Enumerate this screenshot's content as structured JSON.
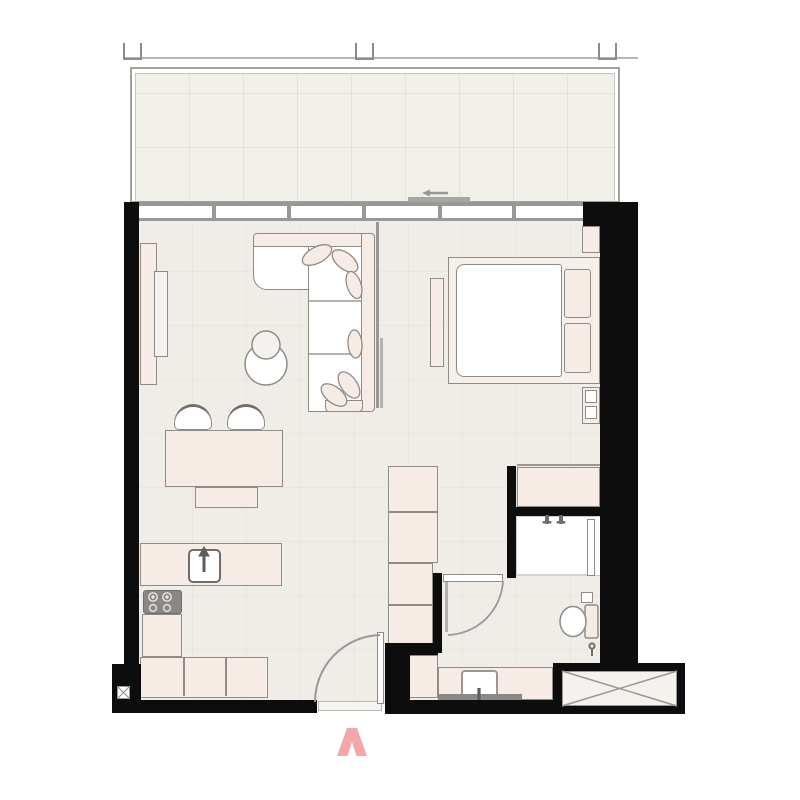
{
  "meta": {
    "title": "One-bedroom apartment floor plan with balcony",
    "type": "architectural-floor-plan"
  },
  "colors": {
    "wall": "#0d0d0d",
    "floor": "#f0ede8",
    "balcony-floor": "#f0efea",
    "furniture-fill": "#f7ebe6",
    "furniture-stroke": "#8f8c88",
    "outline-gray": "#9a9896",
    "rail-gray": "#a3a19e",
    "panel-gray": "#f4f2ee",
    "fixture-dark": "#8a8784",
    "white": "#ffffff",
    "accent-arrow": "#f2a8a6"
  },
  "rooms": [
    {
      "name": "balcony"
    },
    {
      "name": "living-room"
    },
    {
      "name": "dining-area"
    },
    {
      "name": "kitchen"
    },
    {
      "name": "bedroom"
    },
    {
      "name": "bathroom"
    },
    {
      "name": "hallway"
    }
  ],
  "furniture": [
    "tv-console",
    "tv-screen",
    "l-shaped-sofa",
    "sofa-pillows",
    "coffee-tables",
    "dining-table",
    "dining-chairs",
    "dining-bench",
    "kitchen-counter",
    "kitchen-sink",
    "cooktop",
    "kitchen-cabinets",
    "double-bed",
    "mattress",
    "bed-pillows",
    "nightstands",
    "bedroom-dresser",
    "bedroom-wardrobe",
    "hallway-wardrobe",
    "shower",
    "shower-glass",
    "toilet",
    "vanity-counter",
    "vanity-sink"
  ],
  "symbols": [
    {
      "name": "entrance-arrow-icon",
      "meaning": "main entrance direction marker"
    },
    {
      "name": "sliding-door-arrow-icon",
      "meaning": "balcony sliding door opening direction"
    },
    {
      "name": "shaft-x-symbol",
      "meaning": "service shaft / duct"
    },
    {
      "name": "wall-shaft-x-symbol",
      "meaning": "small duct in wall"
    },
    {
      "name": "door-swing-arc",
      "meaning": "door swing path"
    }
  ]
}
